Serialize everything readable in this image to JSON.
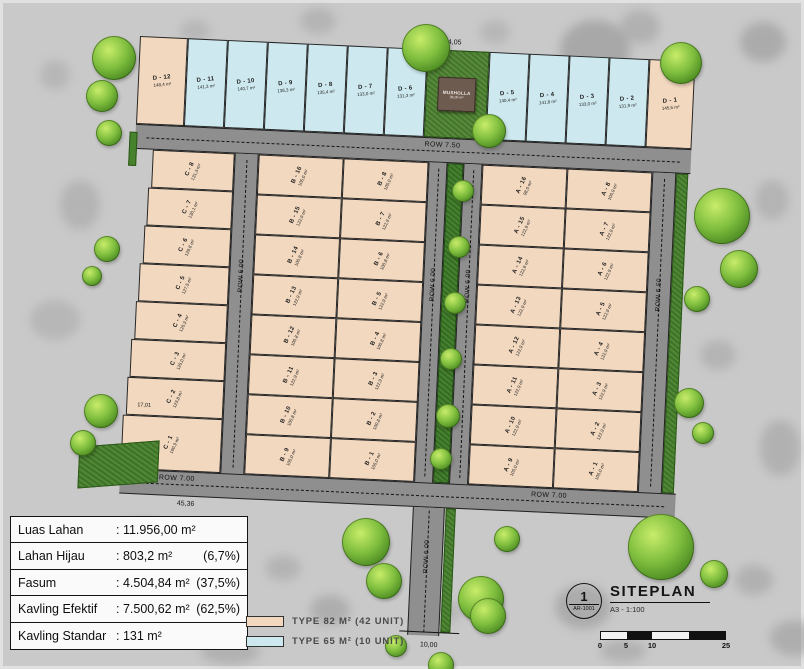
{
  "roads": {
    "top": "ROW 7.50",
    "left": "ROW 6.00",
    "median_left": "ROW 6.00",
    "median_right": "ROW 6.00",
    "right": "ROW 6.50",
    "bottom_left": "ROW 7.00",
    "bottom_right": "ROW 7.00",
    "entrance": "ROW 6.00"
  },
  "dimensions": {
    "top": "124,05",
    "bottom_left": "45,36",
    "entrance_width": "10,00",
    "c1_width": "17,01"
  },
  "musholla": {
    "name": "MUSHOLLA",
    "area": "36,00 m²"
  },
  "lots": {
    "d_left": [
      {
        "id": "D - 12",
        "area": "148,4 m²",
        "type": "t82"
      },
      {
        "id": "D - 11",
        "area": "141,3 m²",
        "type": "t65"
      },
      {
        "id": "D - 10",
        "area": "140,7 m²",
        "type": "t65"
      },
      {
        "id": "D - 9",
        "area": "138,3 m²",
        "type": "t65"
      },
      {
        "id": "D - 8",
        "area": "135,4 m²",
        "type": "t65"
      },
      {
        "id": "D - 7",
        "area": "133,0 m²",
        "type": "t65"
      },
      {
        "id": "D - 6",
        "area": "131,3 m²",
        "type": "t65"
      }
    ],
    "d_right": [
      {
        "id": "D - 5",
        "area": "140,4 m²",
        "type": "t65"
      },
      {
        "id": "D - 4",
        "area": "141,8 m²",
        "type": "t65"
      },
      {
        "id": "D - 3",
        "area": "133,0 m²",
        "type": "t65"
      },
      {
        "id": "D - 2",
        "area": "131,9 m²",
        "type": "t65"
      },
      {
        "id": "D - 1",
        "area": "145,5 m²",
        "type": "t82"
      }
    ],
    "c_col": [
      {
        "id": "C - 8",
        "area": "131,3 m²"
      },
      {
        "id": "C - 7",
        "area": "130,1 m²"
      },
      {
        "id": "C - 6",
        "area": "128,8 m²"
      },
      {
        "id": "C - 5",
        "area": "127,5 m²"
      },
      {
        "id": "C - 4",
        "area": "126,3 m²"
      },
      {
        "id": "C - 3",
        "area": "125,0 m²"
      },
      {
        "id": "C - 2",
        "area": "123,8 m²"
      },
      {
        "id": "C - 1",
        "area": "160,9 m²"
      }
    ],
    "b_left": [
      {
        "id": "B - 16",
        "area": "105,0 m²"
      },
      {
        "id": "B - 15",
        "area": "122,9 m²"
      },
      {
        "id": "B - 14",
        "area": "100,8 m²"
      },
      {
        "id": "B - 13",
        "area": "122,9 m²"
      },
      {
        "id": "B - 12",
        "area": "100,8 m²"
      },
      {
        "id": "B - 11",
        "area": "122,9 m²"
      },
      {
        "id": "B - 10",
        "area": "100,8 m²"
      },
      {
        "id": "B - 9",
        "area": "105,0 m²"
      }
    ],
    "b_right": [
      {
        "id": "B - 8",
        "area": "105,0 m²"
      },
      {
        "id": "B - 7",
        "area": "122,9 m²"
      },
      {
        "id": "B - 6",
        "area": "100,8 m²"
      },
      {
        "id": "B - 5",
        "area": "122,9 m²"
      },
      {
        "id": "B - 4",
        "area": "100,8 m²"
      },
      {
        "id": "B - 3",
        "area": "122,9 m²"
      },
      {
        "id": "B - 2",
        "area": "100,8 m²"
      },
      {
        "id": "B - 1",
        "area": "105,0 m²"
      }
    ],
    "a_left": [
      {
        "id": "A - 16",
        "area": "98,0 m²"
      },
      {
        "id": "A - 15",
        "area": "122,9 m²"
      },
      {
        "id": "A - 14",
        "area": "122,9 m²"
      },
      {
        "id": "A - 13",
        "area": "122,9 m²"
      },
      {
        "id": "A - 12",
        "area": "122,9 m²"
      },
      {
        "id": "A - 11",
        "area": "122,9 m²"
      },
      {
        "id": "A - 10",
        "area": "122,9 m²"
      },
      {
        "id": "A - 9",
        "area": "105,0 m²"
      }
    ],
    "a_right": [
      {
        "id": "A - 8",
        "area": "106,9 m²"
      },
      {
        "id": "A - 7",
        "area": "122,9 m²"
      },
      {
        "id": "A - 6",
        "area": "122,9 m²"
      },
      {
        "id": "A - 5",
        "area": "122,9 m²"
      },
      {
        "id": "A - 4",
        "area": "122,9 m²"
      },
      {
        "id": "A - 3",
        "area": "122,9 m²"
      },
      {
        "id": "A - 2",
        "area": "122,9 m²"
      },
      {
        "id": "A - 1",
        "area": "105,0 m²"
      }
    ]
  },
  "summary_table": {
    "rows": [
      {
        "label": "Luas Lahan",
        "value": ": 11.956,00 m²",
        "pct": ""
      },
      {
        "label": "Lahan Hijau",
        "value": ": 803,2 m²",
        "pct": "(6,7%)"
      },
      {
        "label": "Fasum",
        "value": ": 4.504,84 m²",
        "pct": "(37,5%)"
      },
      {
        "label": "Kavling Efektif",
        "value": ": 7.500,62 m²",
        "pct": "(62,5%)"
      },
      {
        "label": "Kavling Standar",
        "value": ": 131 m²",
        "pct": ""
      }
    ]
  },
  "legend": {
    "items": [
      {
        "label": "TYPE 82 M² (42 UNIT)",
        "color": "#f2d8bf"
      },
      {
        "label": "TYPE 65 M² (10 UNIT)",
        "color": "#cde9ef"
      }
    ]
  },
  "title_block": {
    "number": "1",
    "sheet": "AR-1001",
    "title": "SITEPLAN",
    "scale": "A3 - 1:100",
    "scale_ticks": [
      "0",
      "5",
      "10",
      "25"
    ]
  },
  "colors": {
    "type82": "#f2d8bf",
    "type65": "#cde9ef",
    "road": "#8f8f8f",
    "grass": "#47822c",
    "background": "#c9c9c9",
    "musholla": "#6e5b50"
  }
}
